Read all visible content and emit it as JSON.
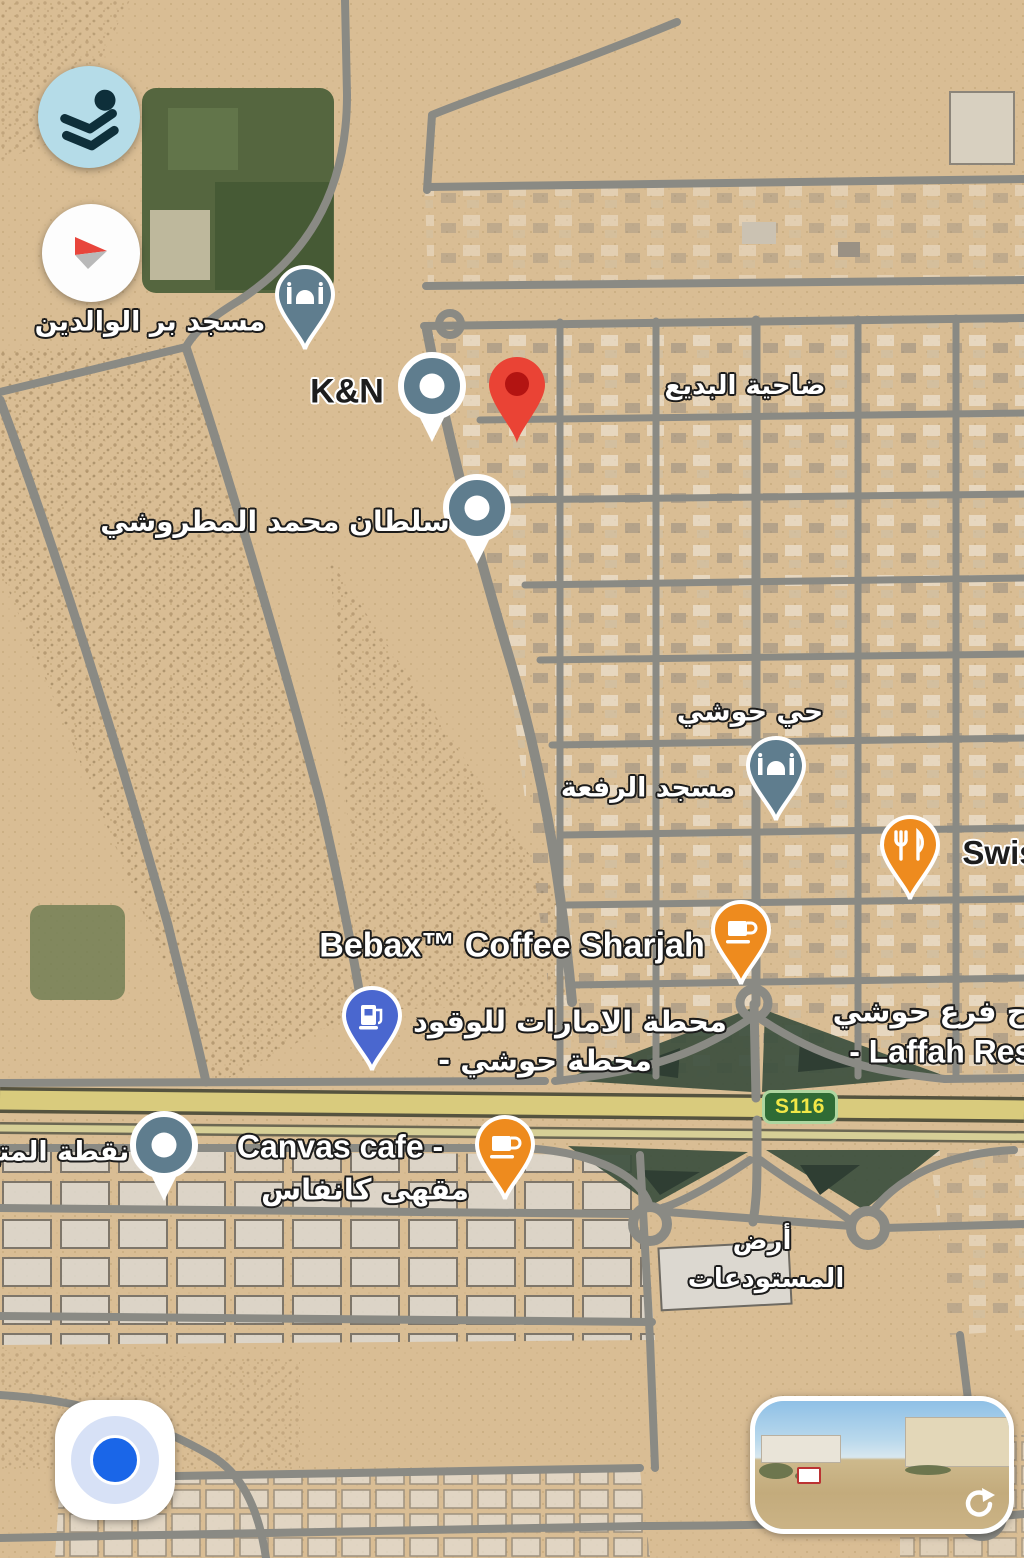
{
  "map_type": "satellite",
  "area_labels": {
    "dahiyat_al_badi": "ضاحية البديع",
    "hay_houshi": "حي حوشي",
    "warehouse_land_line1": "أرض",
    "warehouse_land_line2": "المستودعات"
  },
  "pois": {
    "mosque_bir_alwalidain": "مسجد بر الوالدين",
    "kn": "K&N",
    "sultan_mohammed_almatroushi": "سلطان محمد المطروشي",
    "masjid_alrifaa": "مسجد الرفعة",
    "swiss_partial": "Swis",
    "bebax_coffee": "Bebax™ Coffee Sharjah",
    "fuel_station_line1": "محطة الامارات للوقود",
    "fuel_station_line2": "- محطة حوشي",
    "laffah_line1": "اح فرع حوشي",
    "laffah_line2": "- Laffah Resta",
    "canvas_cafe_line1": "Canvas cafe -",
    "canvas_cafe_line2": "مقهى كانفاس",
    "nuqtat_almuta_partial": "نقطة المتع"
  },
  "road_badges": {
    "s116": "S116"
  },
  "icons": {
    "layers": "layers-icon",
    "compass": "compass-needle-icon",
    "my_location": "my-location-dot-icon",
    "street_view": "street-view-refresh-icon",
    "mosque": "mosque-icon",
    "generic_poi": "poi-dot-icon",
    "restaurant": "fork-knife-icon",
    "coffee": "coffee-cup-icon",
    "fuel": "gas-pump-icon",
    "dropped_pin": "red-map-pin-icon"
  },
  "colors": {
    "sand": "#d9bd94",
    "poi_slate": "#5f7d8e",
    "poi_orange": "#ee8b1e",
    "gas_blue": "#4a67cf",
    "pin_red": "#EA4335",
    "pin_red_inner": "#B31412",
    "layers_bg": "#b5dce8",
    "location_blue": "#1a66e8",
    "s116_green": "#2f6b35",
    "s116_text": "#f2e847",
    "highway_yellow": "#d9cb7d"
  }
}
